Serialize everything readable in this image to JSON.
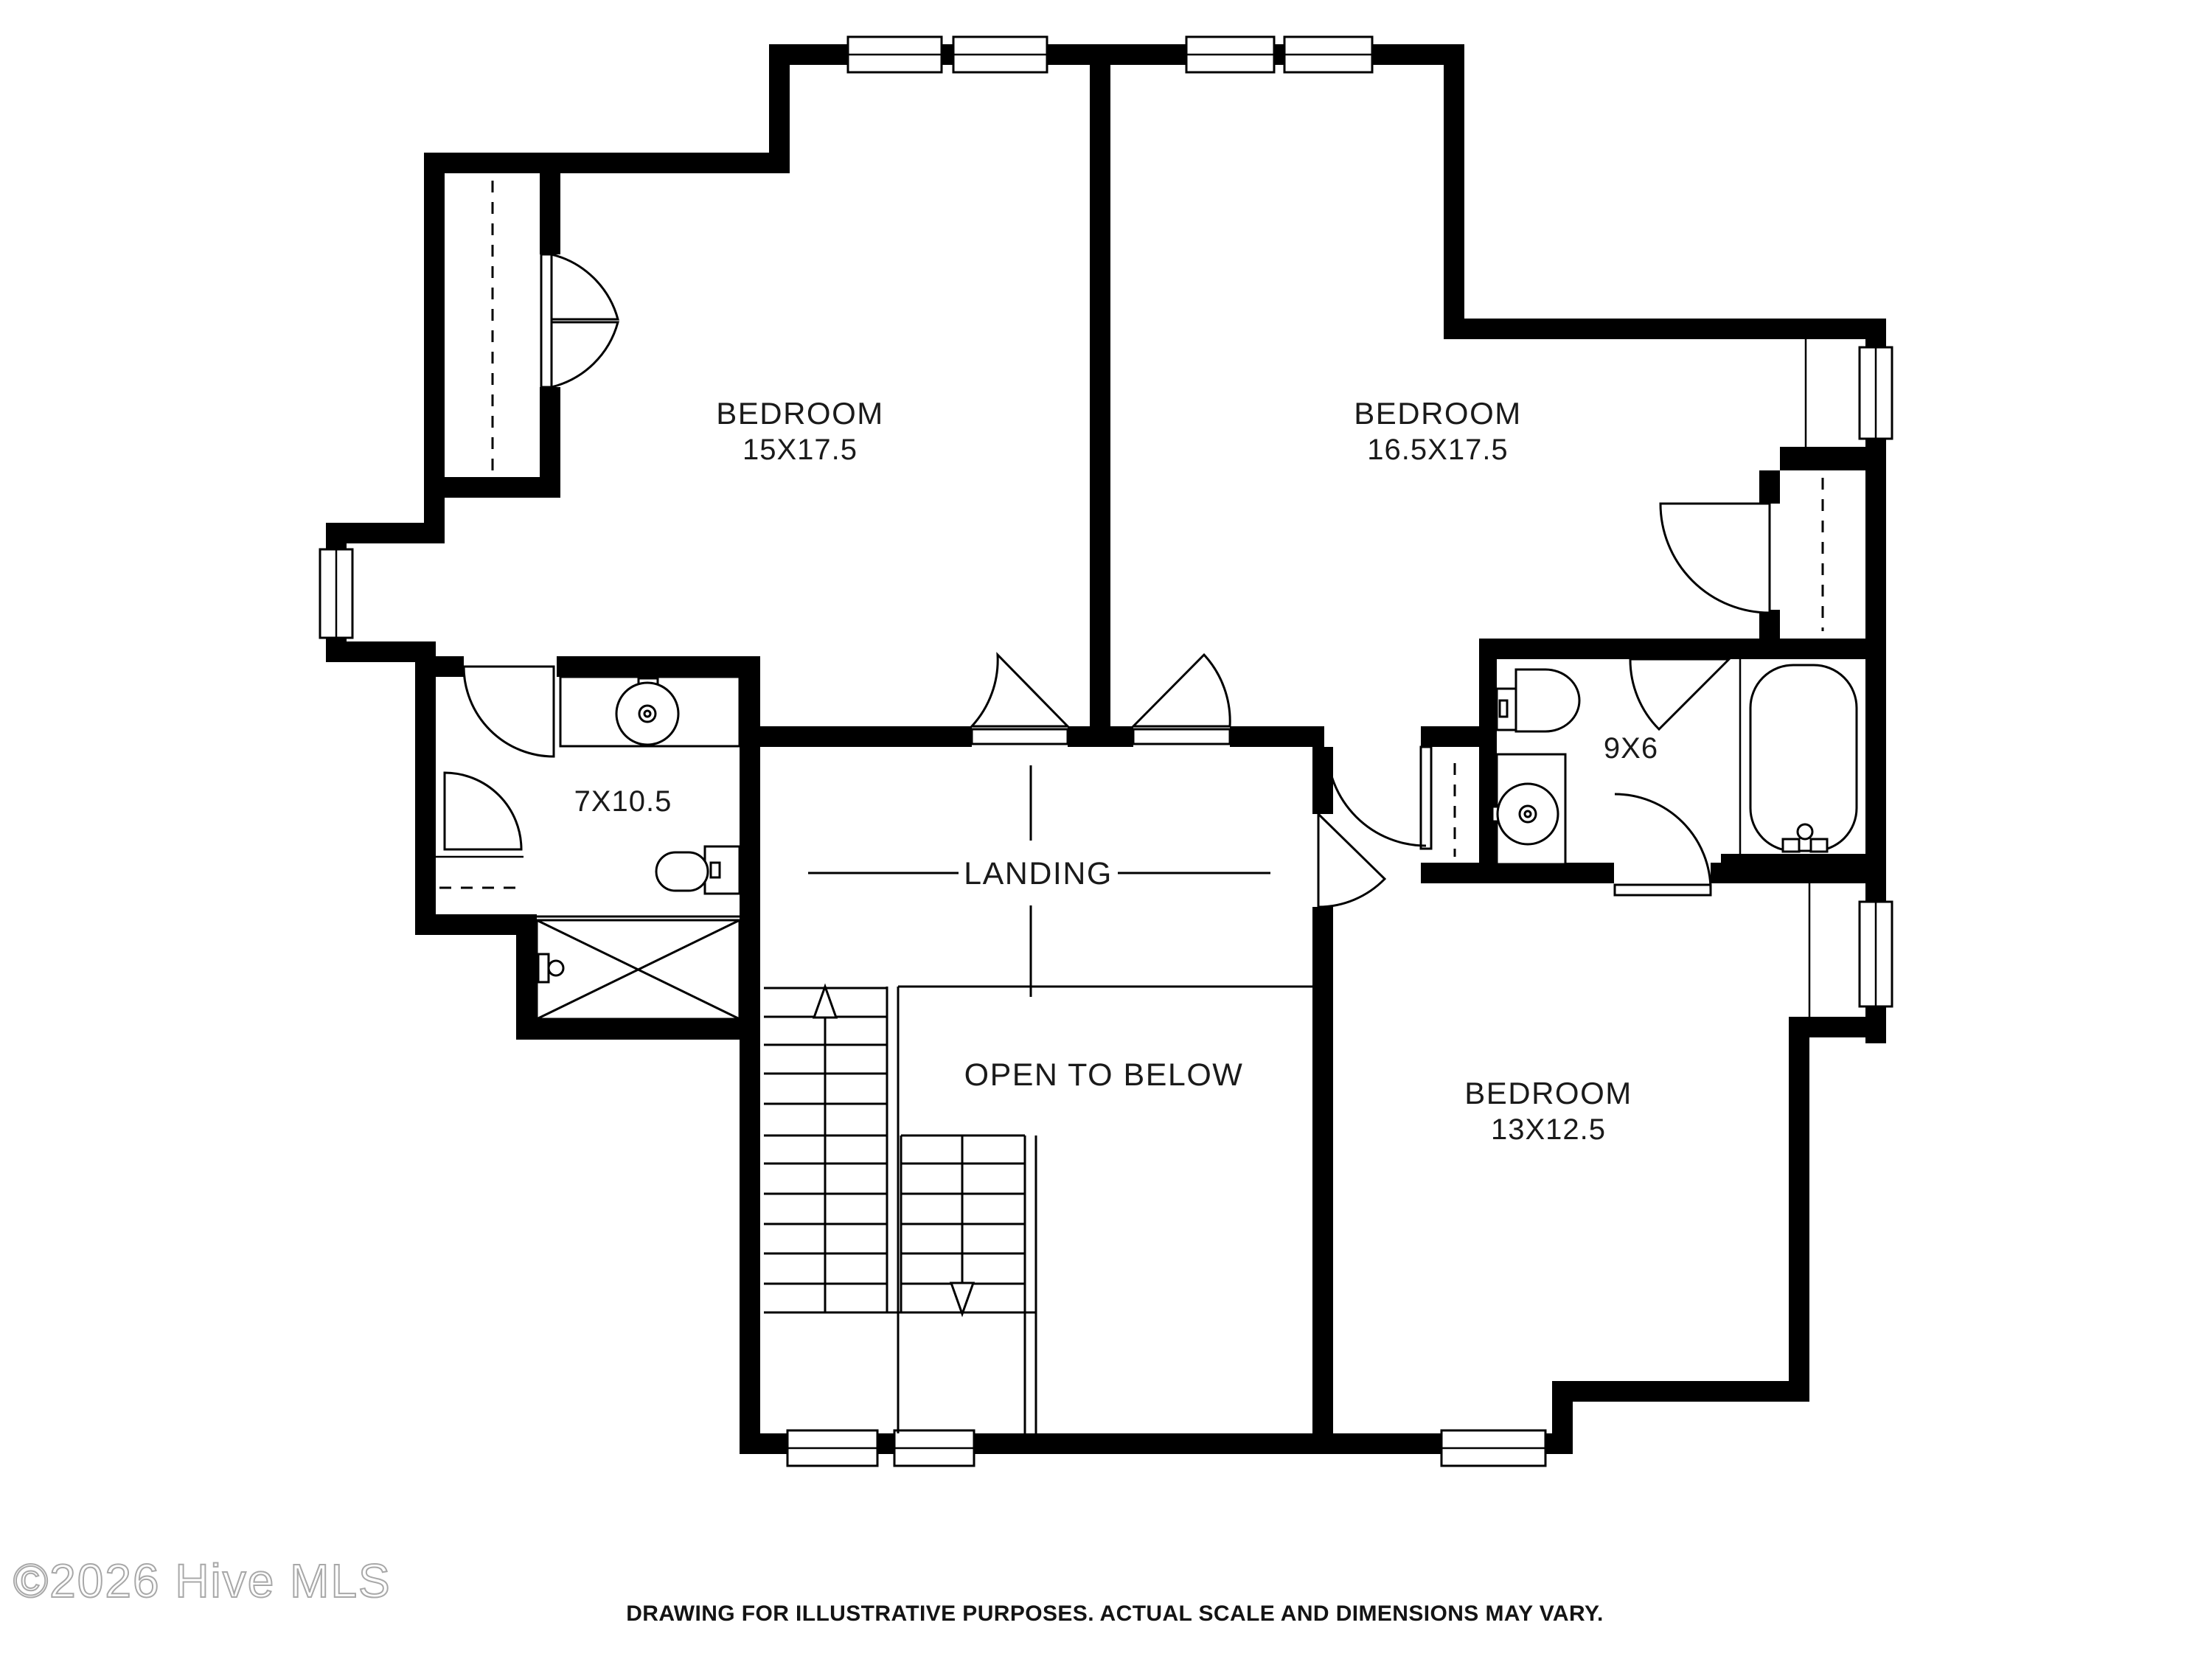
{
  "meta": {
    "type": "floor-plan"
  },
  "colors": {
    "background": "#ffffff",
    "walls": "#000000",
    "lines": "#000000",
    "text": "#1a1a1a",
    "watermark": "#a8a8a8"
  },
  "rooms": {
    "bedroom1": {
      "label": "BEDROOM",
      "dims": "15X17.5"
    },
    "bedroom2": {
      "label": "BEDROOM",
      "dims": "16.5X17.5"
    },
    "bedroom3": {
      "label": "BEDROOM",
      "dims": "13X12.5"
    },
    "bath1": {
      "dims": "7X10.5"
    },
    "bath2": {
      "dims": "9X6"
    },
    "landing": {
      "label": "LANDING"
    },
    "open_to_below": {
      "label": "OPEN TO BELOW"
    }
  },
  "watermark": {
    "text": "©2026 Hive MLS"
  },
  "footer": {
    "disclaimer": "DRAWING FOR ILLUSTRATIVE PURPOSES. ACTUAL SCALE AND DIMENSIONS MAY VARY."
  }
}
